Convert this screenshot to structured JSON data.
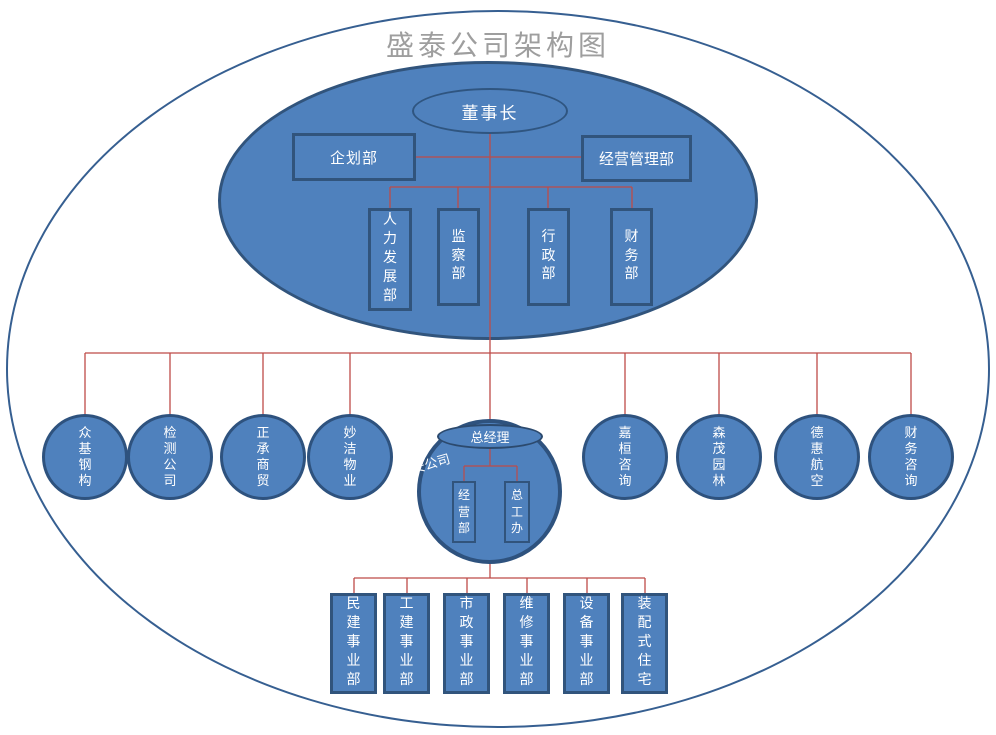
{
  "title": "盛泰公司架构图",
  "headquarters": {
    "chairman": "董事长",
    "planning_dept": "企划部",
    "operations_mgmt_dept": "经营管理部",
    "depts": [
      "人力发展部",
      "监察部",
      "行政部",
      "财务部"
    ]
  },
  "subsidiaries_left": [
    "众基钢构",
    "检测公司",
    "正承商贸",
    "妙洁物业"
  ],
  "subsidiaries_right": [
    "嘉桓咨询",
    "森茂园林",
    "德惠航空",
    "财务咨询"
  ],
  "jianan": {
    "company": "建安公司",
    "general_manager": "总经理",
    "offices": [
      "经营部",
      "总工办"
    ],
    "divisions": [
      "民建事业部",
      "工建事业部",
      "市政事业部",
      "维修事业部",
      "设备事业部",
      "装配式住宅"
    ]
  },
  "colors": {
    "node_fill": "#4f81bd",
    "node_border": "#31547c",
    "outer_ellipse_border": "#365f91",
    "connector_line": "#be4b48",
    "title_text": "#9e9e9e",
    "node_text": "#ffffff"
  }
}
